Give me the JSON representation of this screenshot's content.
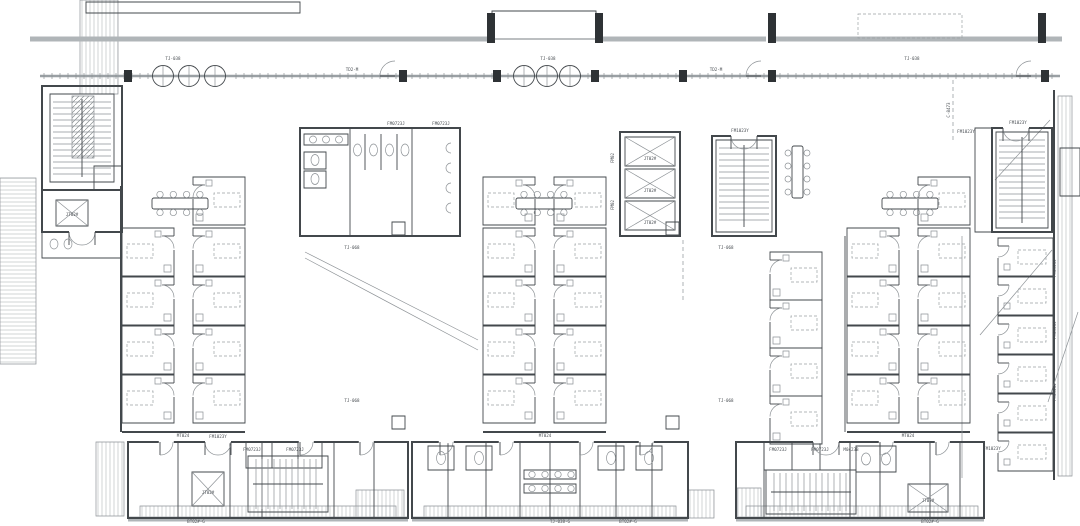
{
  "colors": {
    "background": "#ffffff",
    "wall_heavy": "#b0b5b8",
    "wall_medium": "#43484c",
    "wall_light": "#8d9296",
    "hatch": "#bcc1c5",
    "text": "#4a4f54",
    "post": "#2e3235",
    "glazing": "#9aa0a4"
  },
  "plan": {
    "labels": [
      {
        "t": "TJ-038",
        "x": 173,
        "y": 60
      },
      {
        "t": "TJ-038",
        "x": 548,
        "y": 60
      },
      {
        "t": "TJ-038",
        "x": 912,
        "y": 60
      },
      {
        "t": "TD2-M",
        "x": 352,
        "y": 71,
        "s": 3.4
      },
      {
        "t": "TD2-M",
        "x": 716,
        "y": 71,
        "s": 3.4
      },
      {
        "t": "FM0723J",
        "x": 396,
        "y": 125
      },
      {
        "t": "FM0723J",
        "x": 441,
        "y": 125
      },
      {
        "t": "FM1023Y",
        "x": 740,
        "y": 132
      },
      {
        "t": "FM1023Y",
        "x": 966,
        "y": 133
      },
      {
        "t": "FM1023Y",
        "x": 1018,
        "y": 124
      },
      {
        "t": "TJ-068",
        "x": 352,
        "y": 249
      },
      {
        "t": "TJ-068",
        "x": 352,
        "y": 402
      },
      {
        "t": "TJ-068",
        "x": 726,
        "y": 249
      },
      {
        "t": "TJ-068",
        "x": 726,
        "y": 402
      },
      {
        "t": "FM02",
        "x": 614,
        "y": 158,
        "r": -90,
        "s": 3.4
      },
      {
        "t": "FM02",
        "x": 614,
        "y": 205,
        "r": -90,
        "s": 3.4
      },
      {
        "t": "JT02#",
        "x": 650,
        "y": 160,
        "s": 3
      },
      {
        "t": "JT02#",
        "x": 650,
        "y": 192,
        "s": 3
      },
      {
        "t": "JT02#",
        "x": 650,
        "y": 224,
        "s": 3
      },
      {
        "t": "JT02#",
        "x": 72,
        "y": 216,
        "s": 3
      },
      {
        "t": "JT02#",
        "x": 208,
        "y": 494,
        "s": 3
      },
      {
        "t": "JT02#",
        "x": 928,
        "y": 502,
        "s": 3
      },
      {
        "t": "FM0923J",
        "x": 1056,
        "y": 268,
        "r": -90,
        "s": 3.4
      },
      {
        "t": "FM0923J",
        "x": 1056,
        "y": 330,
        "r": -90,
        "s": 3.4
      },
      {
        "t": "FM0923J",
        "x": 1056,
        "y": 392,
        "r": -90,
        "s": 3.4
      },
      {
        "t": "C-8473",
        "x": 950,
        "y": 110,
        "r": -90,
        "s": 3.2
      },
      {
        "t": "FM0723J",
        "x": 252,
        "y": 451
      },
      {
        "t": "FM0723J",
        "x": 295,
        "y": 451
      },
      {
        "t": "FM1023Y",
        "x": 218,
        "y": 438
      },
      {
        "t": "FM0723J",
        "x": 778,
        "y": 451
      },
      {
        "t": "FM0723J",
        "x": 820,
        "y": 451
      },
      {
        "t": "M0423B",
        "x": 851,
        "y": 451,
        "s": 3.4
      },
      {
        "t": "FM1023Y",
        "x": 992,
        "y": 450
      },
      {
        "t": "BT02#-G",
        "x": 196,
        "y": 523
      },
      {
        "t": "TJ-038-G",
        "x": 560,
        "y": 523
      },
      {
        "t": "BT02#-G",
        "x": 628,
        "y": 523
      },
      {
        "t": "BT02#-G",
        "x": 930,
        "y": 523
      },
      {
        "t": "MT024",
        "x": 183,
        "y": 437,
        "s": 3.2
      },
      {
        "t": "MT024",
        "x": 545,
        "y": 437,
        "s": 3.2
      },
      {
        "t": "MT024",
        "x": 908,
        "y": 437,
        "s": 3.2
      }
    ]
  }
}
